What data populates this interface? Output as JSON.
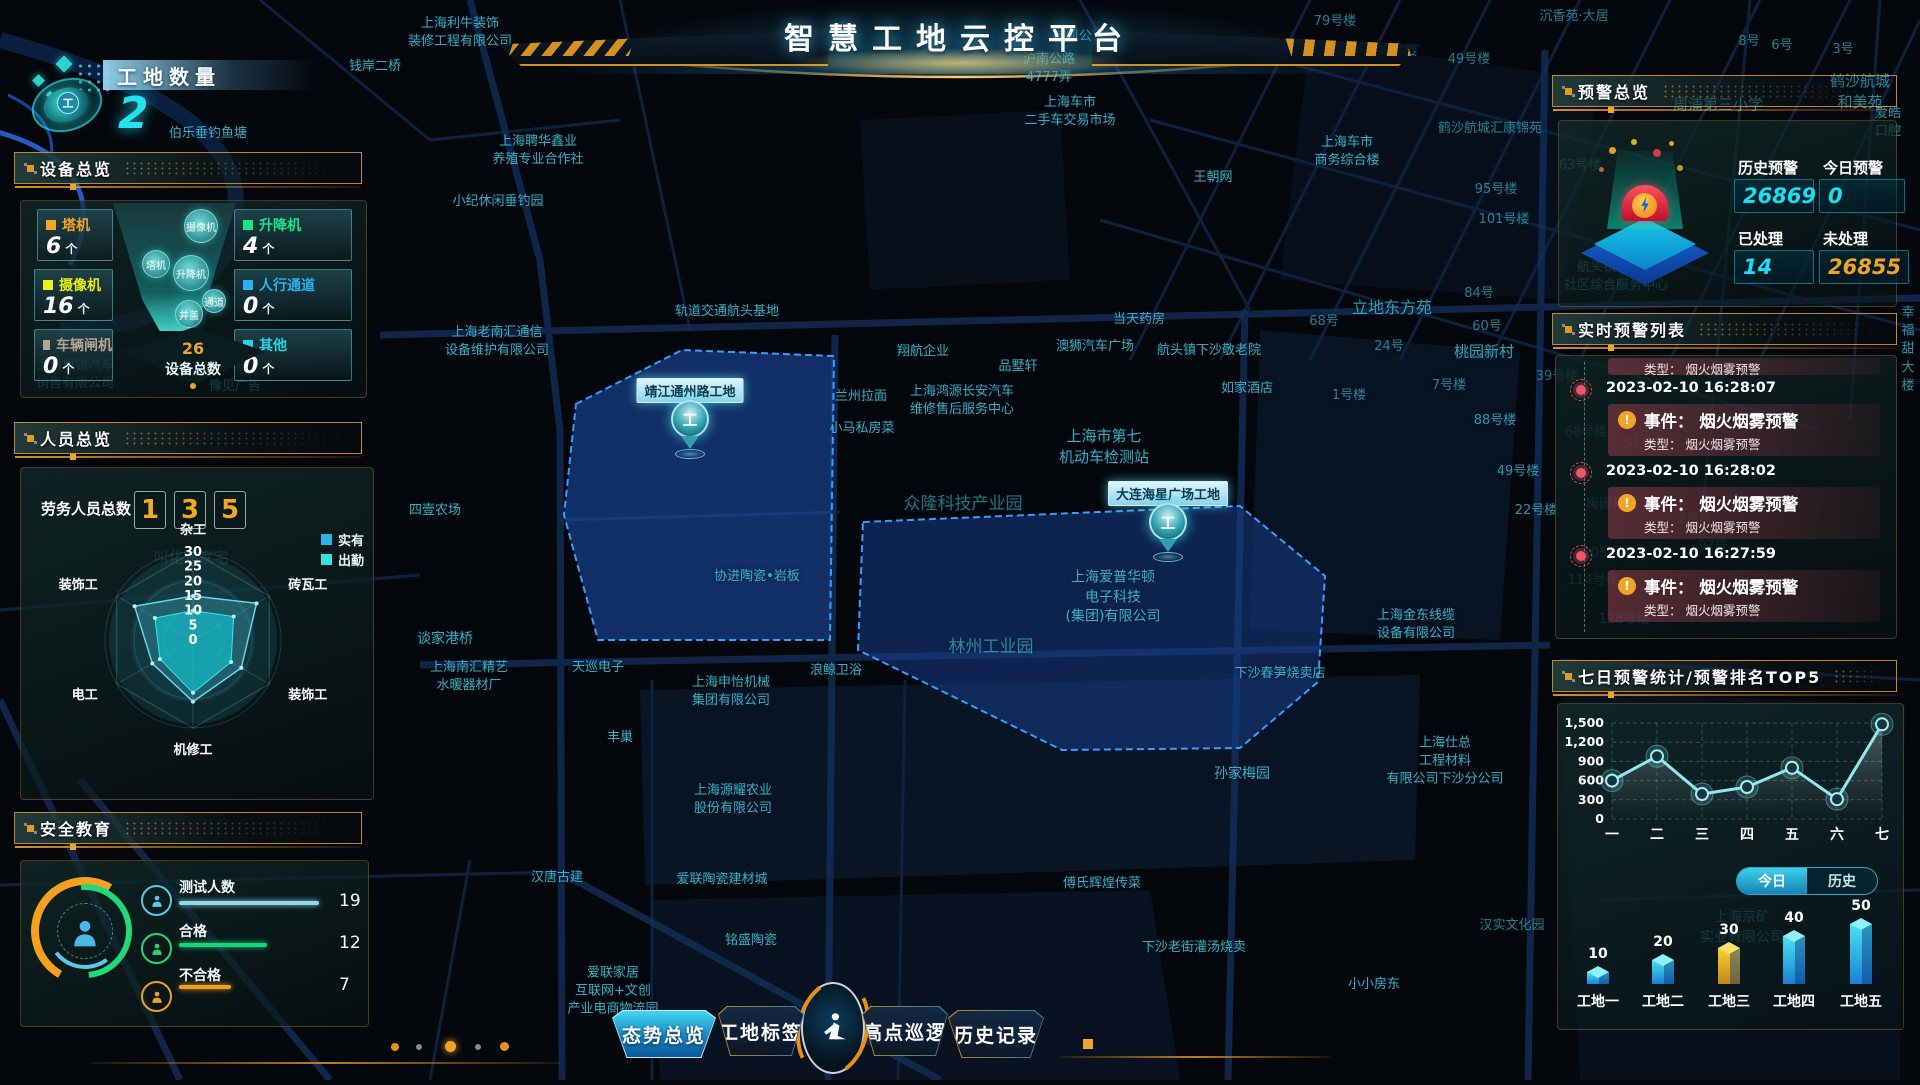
{
  "header": {
    "title": "智慧工地云控平台"
  },
  "site_count": {
    "label": "工地数量",
    "value": "2"
  },
  "panels": {
    "device": {
      "title": "设备总览",
      "items": [
        {
          "label": "塔机",
          "value": "6",
          "unit": "个",
          "color": "#f5a623"
        },
        {
          "label": "升降机",
          "value": "4",
          "unit": "个",
          "color": "#19e68c"
        },
        {
          "label": "摄像机",
          "value": "16",
          "unit": "个",
          "color": "#e8f018"
        },
        {
          "label": "人行通道",
          "value": "0",
          "unit": "个",
          "color": "#28b4f0"
        },
        {
          "label": "车辆闸机",
          "value": "0",
          "unit": "个",
          "color": "#b8a493"
        },
        {
          "label": "其他",
          "value": "0",
          "unit": "个",
          "color": "#20d8e8"
        }
      ],
      "funnel_bubbles": [
        "摄像机",
        "塔机",
        "升降机",
        "通道",
        "井盖"
      ],
      "total": {
        "value": "26",
        "label": "设备总数"
      }
    },
    "personnel": {
      "title": "人员总览",
      "total_label": "劳务人员总数",
      "total_digits": [
        "1",
        "3",
        "5"
      ],
      "legend": [
        {
          "label": "实有",
          "color": "#2bb3e8"
        },
        {
          "label": "出勤",
          "color": "#35e0e0"
        }
      ],
      "radar": {
        "axes": [
          "杂工",
          "砖瓦工",
          "装饰工",
          "机修工",
          "电工",
          "装饰工"
        ],
        "max": 30,
        "ticks": [
          30,
          25,
          20,
          15,
          10,
          5,
          0
        ],
        "series": [
          {
            "name": "实有",
            "values": [
              15,
              25,
              19,
              21,
              16,
              23
            ]
          },
          {
            "name": "出勤",
            "values": [
              10,
              16,
              15,
              18,
              13,
              15
            ]
          }
        ]
      }
    },
    "safety": {
      "title": "安全教育",
      "rows": [
        {
          "label": "测试人数",
          "value": "19",
          "color": "#8fd8e8",
          "max": 19
        },
        {
          "label": "合格",
          "value": "12",
          "color": "#12d87a",
          "max": 19
        },
        {
          "label": "不合格",
          "value": "7",
          "color": "#f0a020",
          "max": 19
        }
      ]
    },
    "alert_overview": {
      "title": "预警总览",
      "stats": [
        {
          "label": "历史预警",
          "value": "26869",
          "color": "cyan"
        },
        {
          "label": "今日预警",
          "value": "0",
          "color": "cyan"
        },
        {
          "label": "已处理",
          "value": "14",
          "color": "cyan"
        },
        {
          "label": "未处理",
          "value": "26855",
          "color": "orange"
        }
      ]
    },
    "alert_list": {
      "title": "实时预警列表",
      "partial_top": "类型： 烟火烟雾预警",
      "items": [
        {
          "time": "2023-02-10 16:28:07",
          "event": "事件： 烟火烟雾预警",
          "type": "类型： 烟火烟雾预警"
        },
        {
          "time": "2023-02-10 16:28:02",
          "event": "事件： 烟火烟雾预警",
          "type": "类型： 烟火烟雾预警"
        },
        {
          "time": "2023-02-10 16:27:59",
          "event": "事件： 烟火烟雾预警",
          "type": "类型： 烟火烟雾预警"
        }
      ]
    },
    "weekly": {
      "title": "七日预警统计/预警排名TOP5",
      "line": {
        "type": "line",
        "categories": [
          "一",
          "二",
          "三",
          "四",
          "五",
          "六",
          "七"
        ],
        "values": [
          600,
          980,
          390,
          500,
          800,
          310,
          1480
        ],
        "yticks": [
          0,
          300,
          600,
          900,
          1200,
          1500
        ],
        "ytick_labels": [
          "0",
          "300",
          "600",
          "900",
          "1,200",
          "1,500"
        ],
        "ylim": [
          0,
          1500
        ]
      },
      "toggle": {
        "today": "今日",
        "history": "历史",
        "active": "今日"
      },
      "bars": {
        "type": "bar",
        "categories": [
          "工地一",
          "工地二",
          "工地三",
          "工地四",
          "工地五"
        ],
        "values": [
          10,
          20,
          30,
          40,
          50
        ],
        "highlight_index": 2,
        "bar_color": "#35d8ec",
        "highlight_color": "#f5d42e"
      }
    }
  },
  "nav": {
    "items": [
      {
        "label": "态势总览",
        "active": true
      },
      {
        "label": "工地标签",
        "active": false
      },
      {
        "label": "高点巡逻",
        "active": false
      },
      {
        "label": "历史记录",
        "active": false
      }
    ]
  },
  "map": {
    "sites": [
      {
        "name": "靖江通州路工地",
        "marker_x": 690,
        "marker_y": 440,
        "polygon": "576,404 682,350 834,356 830,640 598,640 564,515",
        "fill": "rgba(30,78,168,0.58)"
      },
      {
        "name": "大连海星广场工地",
        "marker_x": 1168,
        "marker_y": 543,
        "polygon": "863,522 1240,506 1325,576 1318,682 1240,748 1062,750 858,650",
        "fill": "rgba(24,64,145,0.5)"
      }
    ],
    "labels": [
      {
        "t": "上海利牛装饰\n装修工程有限公司",
        "x": 460,
        "y": 33
      },
      {
        "t": "钱岸二桥",
        "x": 375,
        "y": 67
      },
      {
        "t": "伯乐垂钓鱼塘",
        "x": 208,
        "y": 134
      },
      {
        "t": "上海聘华鑫业\n养殖专业合作社",
        "x": 538,
        "y": 151
      },
      {
        "t": "小纪休闲垂钓园",
        "x": 498,
        "y": 202
      },
      {
        "t": "轨道交通航头基地",
        "x": 727,
        "y": 312
      },
      {
        "t": "上海老南汇通信\n设备维护有限公司",
        "x": 497,
        "y": 342
      },
      {
        "t": "翔航企业",
        "x": 923,
        "y": 352
      },
      {
        "t": "兰州拉面",
        "x": 861,
        "y": 397
      },
      {
        "t": "上海鸿源长安汽车\n维修售后服务中心",
        "x": 962,
        "y": 401
      },
      {
        "t": "品墅轩",
        "x": 1018,
        "y": 367
      },
      {
        "t": "澳狮汽车广场",
        "x": 1095,
        "y": 347
      },
      {
        "t": "航头镇下沙敬老院",
        "x": 1209,
        "y": 351
      },
      {
        "t": "如家酒店",
        "x": 1247,
        "y": 389
      },
      {
        "t": "小马私房菜",
        "x": 862,
        "y": 429
      },
      {
        "t": "当天药房",
        "x": 1139,
        "y": 320
      },
      {
        "t": "上海市第七\n机动车检测站",
        "x": 1104,
        "y": 447,
        "fs": 15
      },
      {
        "t": "众隆科技产业园",
        "x": 963,
        "y": 505,
        "fs": 17,
        "o": 0.55
      },
      {
        "t": "协进陶瓷•岩板",
        "x": 757,
        "y": 577
      },
      {
        "t": "林州工业园",
        "x": 991,
        "y": 648,
        "fs": 17,
        "o": 0.6
      },
      {
        "t": "上海爱普华顿\n电子科技\n(集团)有限公司",
        "x": 1113,
        "y": 598,
        "fs": 14
      },
      {
        "t": "四壹农场",
        "x": 435,
        "y": 511
      },
      {
        "t": "谈家港桥",
        "x": 445,
        "y": 640,
        "fs": 14
      },
      {
        "t": "上海南汇精艺\n水暖器材厂",
        "x": 469,
        "y": 677
      },
      {
        "t": "天巡电子",
        "x": 598,
        "y": 668
      },
      {
        "t": "上海申怡机械\n集团有限公司",
        "x": 731,
        "y": 692
      },
      {
        "t": "浪鲸卫浴",
        "x": 836,
        "y": 671
      },
      {
        "t": "丰巢",
        "x": 620,
        "y": 738
      },
      {
        "t": "上海源耀农业\n股份有限公司",
        "x": 733,
        "y": 800
      },
      {
        "t": "汉唐古建",
        "x": 557,
        "y": 878
      },
      {
        "t": "爱联陶瓷建材城",
        "x": 722,
        "y": 880
      },
      {
        "t": "铭盛陶瓷",
        "x": 751,
        "y": 941
      },
      {
        "t": "爱联家居\n互联网+文创\n产业电商物流园",
        "x": 613,
        "y": 992
      },
      {
        "t": "科勒",
        "x": 833,
        "y": 993
      },
      {
        "t": "傅氏辉煌传菜",
        "x": 1102,
        "y": 884
      },
      {
        "t": "下沙老街灌汤烧卖",
        "x": 1194,
        "y": 948
      },
      {
        "t": "小小房东",
        "x": 1374,
        "y": 985
      },
      {
        "t": "孙家梅园",
        "x": 1242,
        "y": 775,
        "fs": 14
      },
      {
        "t": "下沙春笋烧卖店",
        "x": 1280,
        "y": 674
      },
      {
        "t": "上海金东线缆\n设备有限公司",
        "x": 1416,
        "y": 625
      },
      {
        "t": "上海仕总\n工程材料\n有限公司下沙分公司",
        "x": 1445,
        "y": 762
      },
      {
        "t": "汉实文化园",
        "x": 1512,
        "y": 926,
        "o": 0.6
      },
      {
        "t": "上海京矿\n实业有限公司",
        "x": 1742,
        "y": 928,
        "o": 0.45,
        "fs": 14
      },
      {
        "t": "桂凯公寓",
        "x": 1079,
        "y": 37
      },
      {
        "t": "沪南公路\n4777弄",
        "x": 1049,
        "y": 69
      },
      {
        "t": "上海车市\n二手车交易市场",
        "x": 1070,
        "y": 112
      },
      {
        "t": "王朝网",
        "x": 1213,
        "y": 178
      },
      {
        "t": "上海车市\n商务综合楼",
        "x": 1347,
        "y": 152
      },
      {
        "t": "79号楼",
        "x": 1335,
        "y": 22,
        "o": 0.6
      },
      {
        "t": "90号楼",
        "x": 1396,
        "y": 52,
        "o": 0.6
      },
      {
        "t": "49号楼",
        "x": 1469,
        "y": 60,
        "o": 0.6
      },
      {
        "t": "沉香苑·大居",
        "x": 1574,
        "y": 17,
        "o": 0.6
      },
      {
        "t": "8号",
        "x": 1749,
        "y": 42,
        "o": 0.6
      },
      {
        "t": "6号",
        "x": 1782,
        "y": 46,
        "o": 0.6
      },
      {
        "t": "3号",
        "x": 1843,
        "y": 50,
        "o": 0.6
      },
      {
        "t": "鹤沙航城和美苑",
        "x": 1860,
        "y": 92,
        "fs": 15,
        "o": 0.8
      },
      {
        "t": "周浦第三小学",
        "x": 1718,
        "y": 105,
        "fs": 15,
        "o": 0.7
      },
      {
        "t": "爱皓口腔",
        "x": 1888,
        "y": 123,
        "o": 0.7
      },
      {
        "t": "鹤沙航城汇康锦苑",
        "x": 1490,
        "y": 129,
        "o": 0.6
      },
      {
        "t": "63号楼",
        "x": 1580,
        "y": 166,
        "o": 0.5
      },
      {
        "t": "95号楼",
        "x": 1496,
        "y": 190,
        "o": 0.6
      },
      {
        "t": "101号楼",
        "x": 1504,
        "y": 220,
        "o": 0.6
      },
      {
        "t": "航头镇沉香村\n社区综合服务中心",
        "x": 1616,
        "y": 277,
        "o": 0.5
      },
      {
        "t": "84号",
        "x": 1479,
        "y": 294,
        "o": 0.6
      },
      {
        "t": "68号",
        "x": 1324,
        "y": 322,
        "o": 0.6
      },
      {
        "t": "立地东方苑",
        "x": 1392,
        "y": 308,
        "fs": 16,
        "o": 0.75
      },
      {
        "t": "60号",
        "x": 1487,
        "y": 327,
        "o": 0.6
      },
      {
        "t": "24号",
        "x": 1389,
        "y": 347,
        "o": 0.6
      },
      {
        "t": "桃园新村",
        "x": 1484,
        "y": 352,
        "fs": 15,
        "o": 0.8
      },
      {
        "t": "1号楼",
        "x": 1349,
        "y": 396,
        "o": 0.6
      },
      {
        "t": "7号楼",
        "x": 1449,
        "y": 386,
        "o": 0.6
      },
      {
        "t": "88号楼",
        "x": 1495,
        "y": 421,
        "o": 0.7
      },
      {
        "t": "49号楼",
        "x": 1518,
        "y": 472,
        "o": 0.7
      },
      {
        "t": "39号楼",
        "x": 1557,
        "y": 377,
        "o": 0.5
      },
      {
        "t": "22号楼",
        "x": 1536,
        "y": 511,
        "o": 0.7
      },
      {
        "t": "梅园新村",
        "x": 1612,
        "y": 505,
        "o": 0.4
      },
      {
        "t": "68号楼",
        "x": 1586,
        "y": 433,
        "o": 0.4
      },
      {
        "t": "51号楼",
        "x": 1645,
        "y": 445,
        "o": 0.35
      },
      {
        "t": "105号楼",
        "x": 1608,
        "y": 554,
        "o": 0.4
      },
      {
        "t": "114号楼",
        "x": 1593,
        "y": 581,
        "o": 0.4
      },
      {
        "t": "128号楼",
        "x": 1624,
        "y": 620,
        "o": 0.4
      },
      {
        "t": "2号楼",
        "x": 1695,
        "y": 520,
        "o": 0.35
      },
      {
        "t": "97号",
        "x": 1713,
        "y": 547,
        "o": 0.35
      },
      {
        "t": "幸福甜大楼",
        "x": 1908,
        "y": 350,
        "o": 0.7
      },
      {
        "t": "上海恩锡汽车\n销售有限公司",
        "x": 75,
        "y": 375,
        "o": 0.5
      },
      {
        "t": "豫见广告",
        "x": 235,
        "y": 387,
        "o": 0.55
      },
      {
        "t": "叫化鸡家宅",
        "x": 191,
        "y": 558,
        "fs": 15,
        "o": 0.45
      }
    ]
  }
}
